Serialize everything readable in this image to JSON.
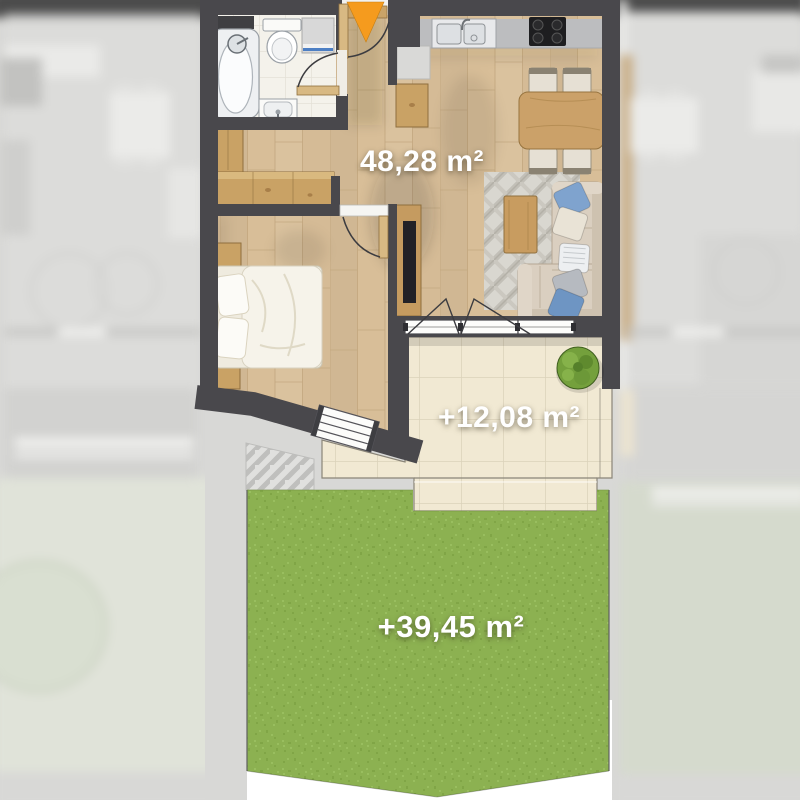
{
  "floor_plan": {
    "apartment": {
      "area_label": "48,28 m²"
    },
    "terrace": {
      "area_label": "+12,08 m²"
    },
    "garden": {
      "area_label": "+39,45 m²"
    },
    "entrance_marker_icon": "entrance-arrow-icon"
  },
  "colors": {
    "wall": "#49484C",
    "wood_floor": "#D8BE98",
    "bathroom_tile": "#F4F2EB",
    "terrace_tile": "#F1E9D3",
    "grass": "#8CB151",
    "entrance_arrow": "#F59B1E",
    "area_label_text": "#FFFFFF"
  }
}
